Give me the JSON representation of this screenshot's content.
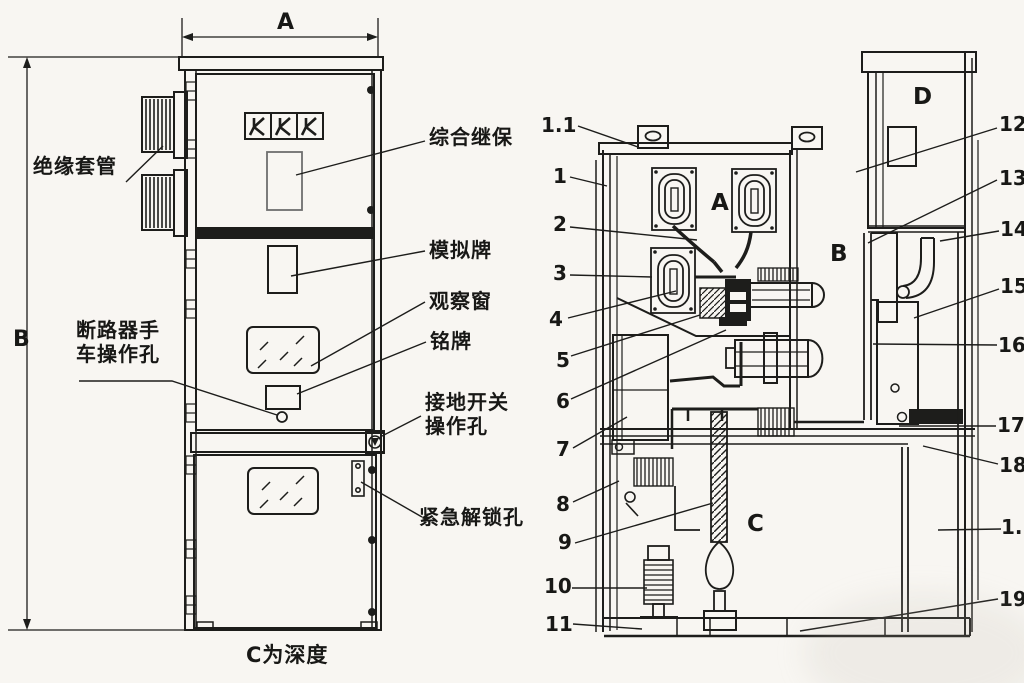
{
  "front_view": {
    "dimension_width_label": "A",
    "dimension_height_label": "B",
    "depth_note": "C为深度",
    "callouts": {
      "insulation_bushing": "绝缘套管",
      "breaker_handcart_hole_line1": "断路器手",
      "breaker_handcart_hole_line2": "车操作孔",
      "integrated_relay": "综合继保",
      "mimic_board": "模拟牌",
      "observation_window": "观察窗",
      "nameplate": "铭牌",
      "earthing_switch_hole_line1": "接地开关",
      "earthing_switch_hole_line2": "操作孔",
      "emergency_unlock_hole": "紧急解锁孔"
    }
  },
  "side_view": {
    "compartment_letters": {
      "a": "A",
      "b": "B",
      "c": "C",
      "d": "D"
    },
    "callouts_left": [
      "1.1",
      "1",
      "2",
      "3",
      "4",
      "5",
      "6",
      "7",
      "8",
      "9",
      "10",
      "11"
    ],
    "callouts_right": [
      "12",
      "13",
      "14",
      "15",
      "16",
      "17",
      "18",
      "1.2",
      "19"
    ]
  },
  "colors": {
    "ink": "#1d1d1b",
    "paper": "#f8f6f2",
    "relay_outline": "#6e6e6e"
  }
}
